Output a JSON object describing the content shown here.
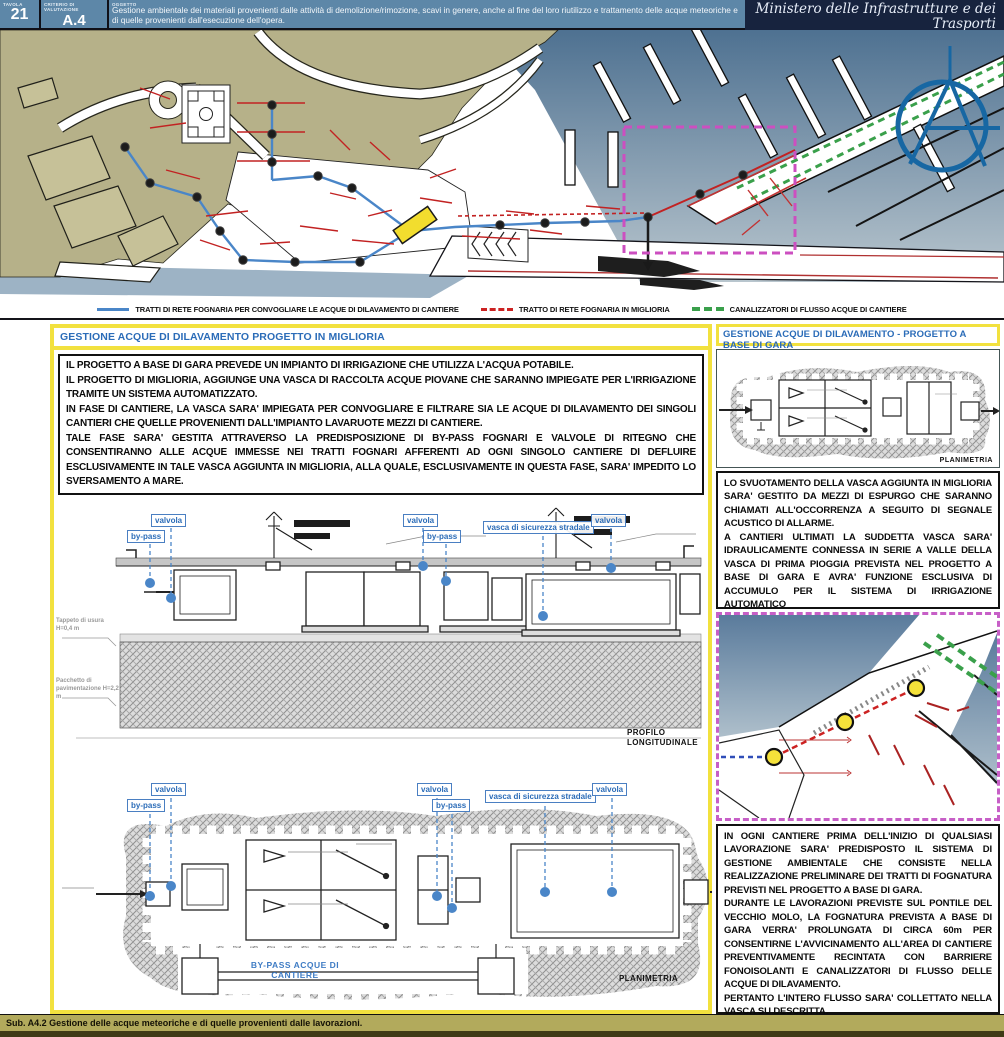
{
  "header": {
    "tavola_label": "TAVOLA",
    "tavola_value": "21",
    "criterio_label": "CRITERIO DI VALUTAZIONE",
    "criterio_value": "A.4",
    "oggetto_label": "OGGETTO",
    "oggetto_text": "Gestione ambientale dei materiali provenienti dalle attività di demolizione/rimozione, scavi in genere, anche al fine del loro riutilizzo e trattamento delle acque meteoriche e di quelle provenienti dall'esecuzione dell'opera.",
    "ministry": "Ministero delle Infrastrutture e dei Trasporti",
    "ministry_sub": "Provveditorato Interregionale per le Opere Pubbliche Campania - Molise - Puglia - Basilicata",
    "colors": {
      "band": "#5d87a8",
      "ministry_band": "#17233e"
    }
  },
  "legend": {
    "items": [
      {
        "label": "TRATTI DI RETE FOGNARIA PER CONVOGLIARE LE ACQUE DI DILAVAMENTO DI CANTIERE",
        "color": "#4a86c8",
        "style": "solid"
      },
      {
        "label": "TRATTO DI RETE FOGNARIA IN MIGLIORIA",
        "color": "#cc2222",
        "style": "solid"
      },
      {
        "label": "CANALIZZATORI DI FLUSSO ACQUE DI CANTIERE",
        "color": "#3aa04b",
        "style": "dashed"
      }
    ]
  },
  "left_panel": {
    "title": "GESTIONE ACQUE DI DILAVAMENTO PROGETTO IN MIGLIORIA",
    "paragraphs": [
      "IL PROGETTO A BASE DI GARA PREVEDE UN IMPIANTO DI IRRIGAZIONE CHE UTILIZZA L'ACQUA POTABILE.",
      "IL PROGETTO DI MIGLIORIA, AGGIUNGE UNA VASCA DI RACCOLTA ACQUE PIOVANE CHE SARANNO IMPIEGATE PER L'IRRIGAZIONE TRAMITE UN SISTEMA AUTOMATIZZATO.",
      "IN FASE DI CANTIERE, LA VASCA SARA' IMPIEGATA PER CONVOGLIARE E FILTRARE SIA LE ACQUE DI DILAVAMENTO DEI SINGOLI CANTIERI CHE QUELLE PROVENIENTI DALL'IMPIANTO LAVARUOTE MEZZI DI CANTIERE.",
      "TALE FASE SARA' GESTITA ATTRAVERSO LA PREDISPOSIZIONE DI BY-PASS FOGNARI E VALVOLE DI RITEGNO CHE CONSENTIRANNO ALLE ACQUE  IMMESSE NEI TRATTI FOGNARI AFFERENTI AD OGNI SINGOLO CANTIERE DI DEFLUIRE ESCLUSIVAMENTE IN TALE VASCA AGGIUNTA IN MIGLIORIA, ALLA QUALE, ESCLUSIVAMENTE IN QUESTA FASE, SARA' IMPEDITO LO SVERSAMENTO A MARE."
    ],
    "profile_caption": "PROFILO LONGITUDINALE",
    "plan_caption": "PLANIMETRIA",
    "bypass_duct_label": "BY-PASS ACQUE DI CANTIERE",
    "margin_note_1": "Tappeto di usura H=0,4 m",
    "margin_note_2": "Pacchetto di pavimentazione H=2,2 m"
  },
  "callouts": {
    "bypass": "by-pass",
    "valvola": "valvola",
    "vasca": "vasca di sicurezza stradale"
  },
  "right_panel": {
    "title": "GESTIONE ACQUE DI DILAVAMENTO - PROGETTO A BASE DI GARA",
    "plan_caption": "PLANIMETRIA",
    "text_block_1": [
      "LO SVUOTAMENTO DELLA VASCA AGGIUNTA IN MIGLIORIA SARA' GESTITO DA MEZZI DI ESPURGO CHE SARANNO CHIAMATI ALL'OCCORRENZA A SEGUITO DI  SEGNALE ACUSTICO DI ALLARME.",
      "A CANTIERI ULTIMATI LA SUDDETTA VASCA SARA' IDRAULICAMENTE CONNESSA IN SERIE A VALLE DELLA VASCA DI PRIMA PIOGGIA PREVISTA NEL PROGETTO A BASE DI GARA E AVRA' FUNZIONE ESCLUSIVA DI ACCUMULO PER IL SISTEMA DI IRRIGAZIONE AUTOMATICO"
    ],
    "text_block_2": [
      "IN OGNI CANTIERE PRIMA DELL'INIZIO DI QUALSIASI LAVORAZIONE SARA' PREDISPOSTO IL SISTEMA DI GESTIONE AMBIENTALE CHE CONSISTE NELLA REALIZZAZIONE PRELIMINARE DEI TRATTI DI FOGNATURA PREVISTI NEL PROGETTO A BASE DI GARA.",
      "DURANTE LE LAVORAZIONI PREVISTE SUL PONTILE DEL VECCHIO MOLO, LA FOGNATURA PREVISTA A BASE DI GARA VERRA' PROLUNGATA DI CIRCA 60m PER CONSENTIRNE L'AVVICINAMENTO ALL'AREA DI CANTIERE PREVENTIVAMENTE RECINTATA CON BARRIERE FONOISOLANTI E CANALIZZATORI DI FLUSSO DELLE ACQUE DI DILAVAMENTO.",
      "PERTANTO L'INTERO FLUSSO SARA' COLLETTATO NELLA VASCA SU DESCRITTA."
    ]
  },
  "footer": {
    "text": "Sub. A4.2   Gestione delle acque meteoriche e di quelle provenienti dalle lavorazioni."
  },
  "map": {
    "colors": {
      "land": "#b6b189",
      "water_deep": "#4e7191",
      "water_light": "#b9c6ce",
      "highlight_box": "#cc4fc0",
      "logo_blue": "#1767a3",
      "marker_yellow": "#f2dd2e"
    }
  }
}
